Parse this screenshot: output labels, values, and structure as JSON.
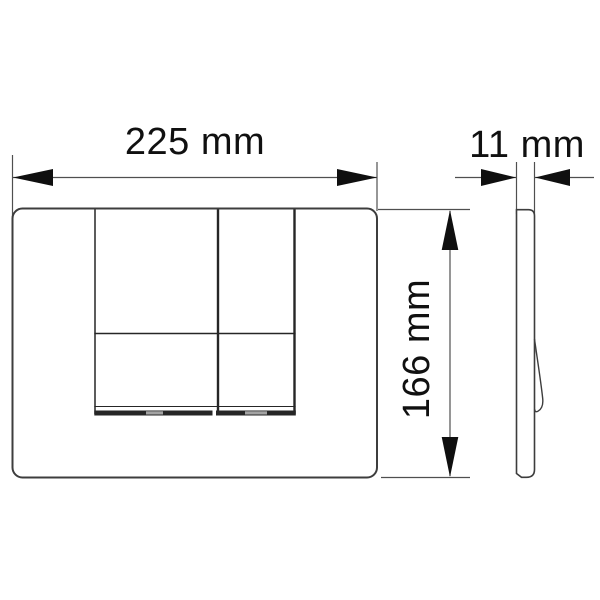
{
  "diagram": {
    "type": "technical-dimension-drawing",
    "subject": "dual-button wall flush plate, front view and side profile view",
    "dimensions": {
      "width": {
        "label": "225 mm",
        "value": 225,
        "unit": "mm"
      },
      "depth": {
        "label": "11 mm",
        "value": 11,
        "unit": "mm"
      },
      "height": {
        "label": "166 mm",
        "value": 166,
        "unit": "mm"
      }
    },
    "colors": {
      "background": "#ffffff",
      "outline": "#3d3d3d",
      "button_edge": "#262626",
      "dim_line": "#4f4f4f",
      "arrow": "#0f0f0f",
      "notch": "#a3a3a3",
      "text": "#101010"
    }
  }
}
